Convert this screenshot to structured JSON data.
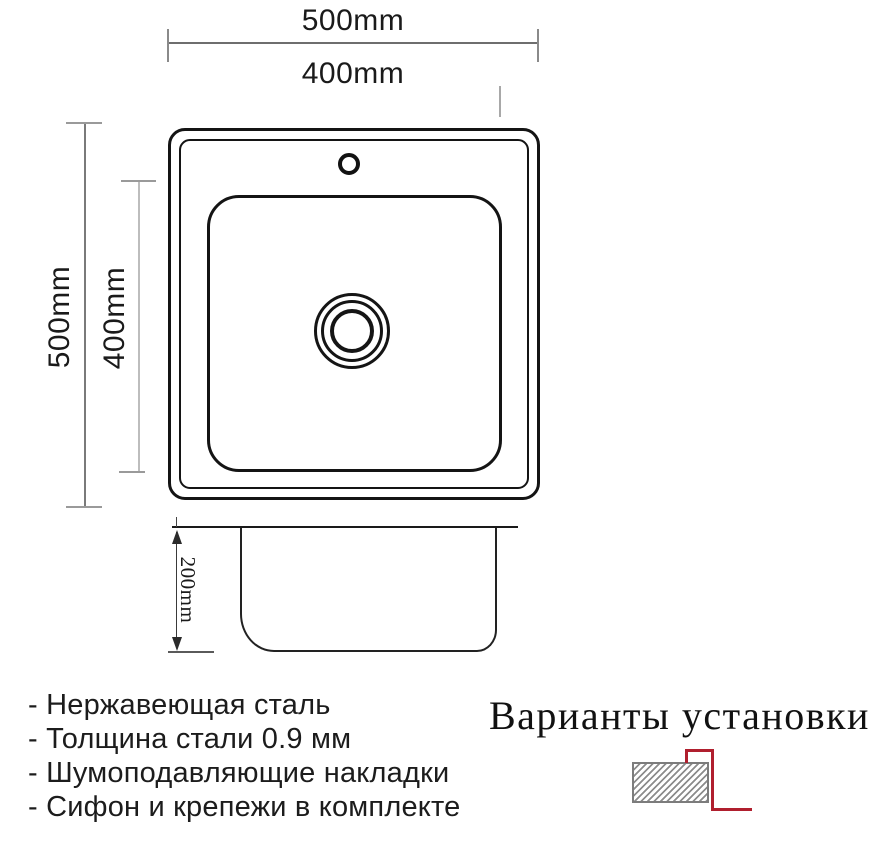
{
  "dimensions": {
    "top_outer_width": "500mm",
    "top_inner_width": "400mm",
    "left_outer_height": "500mm",
    "left_inner_height": "400mm",
    "side_depth": "200mm"
  },
  "features": [
    "- Нержавеющая сталь",
    "- Толщина стали 0.9 мм",
    "- Шумоподавляющие накладки",
    "- Сифон и крепежи в комплекте"
  ],
  "installation": {
    "heading": "Варианты установки"
  },
  "colors": {
    "drawing_line": "#141414",
    "dimension_line": "#6e6e6e",
    "accent_red": "#b01f2e",
    "hatch_gray": "#8c8c8c"
  }
}
